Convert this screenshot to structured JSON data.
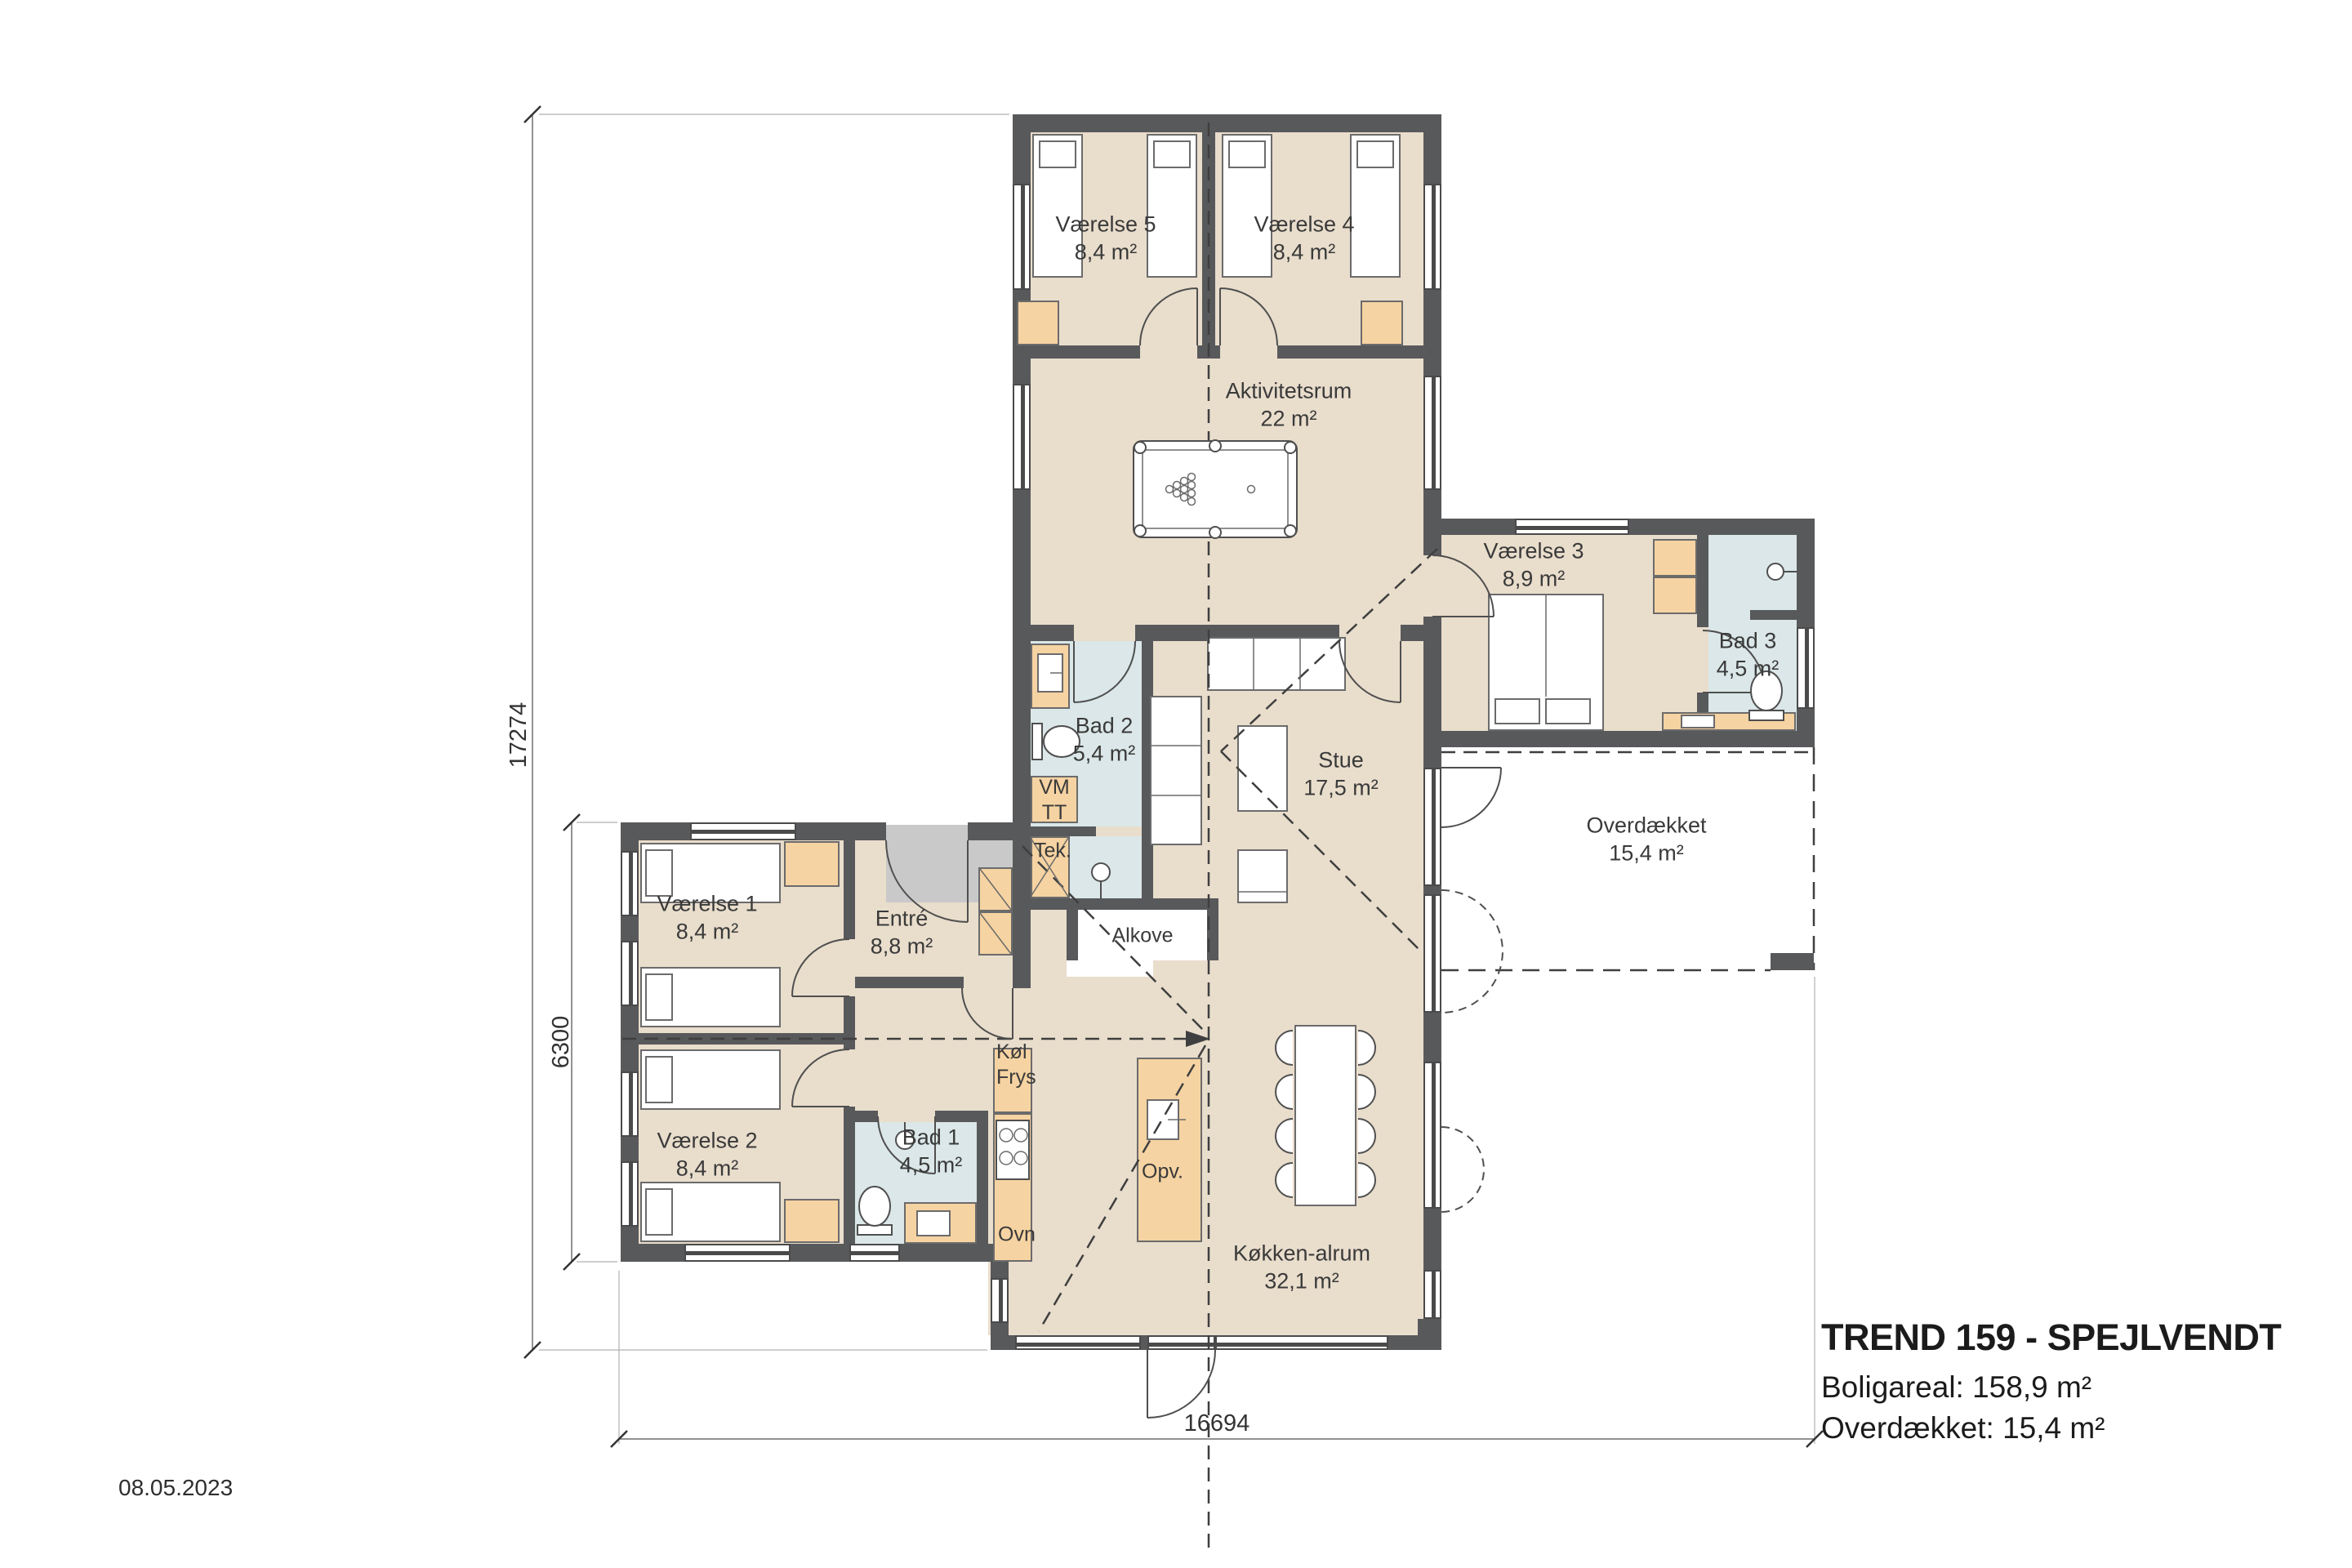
{
  "drawing": {
    "title": "TREND 159 - SPEJLVENDT",
    "area_line1": "Boligareal: 158,9 m²",
    "area_line2": "Overdækket: 15,4 m²",
    "date": "08.05.2023"
  },
  "rooms": {
    "vaerelse5": {
      "name": "Værelse 5",
      "area": "8,4 m²"
    },
    "vaerelse4": {
      "name": "Værelse 4",
      "area": "8,4 m²"
    },
    "aktivitetsrum": {
      "name": "Aktivitetsrum",
      "area": "22 m²"
    },
    "vaerelse3": {
      "name": "Værelse 3",
      "area": "8,9 m²"
    },
    "bad3": {
      "name": "Bad 3",
      "area": "4,5 m²"
    },
    "bad2": {
      "name": "Bad 2",
      "area": "5,4 m²"
    },
    "stue": {
      "name": "Stue",
      "area": "17,5 m²"
    },
    "overdaekket": {
      "name": "Overdækket",
      "area": "15,4 m²"
    },
    "vaerelse1": {
      "name": "Værelse 1",
      "area": "8,4 m²"
    },
    "entre": {
      "name": "Entré",
      "area": "8,8 m²"
    },
    "vaerelse2": {
      "name": "Værelse 2",
      "area": "8,4 m²"
    },
    "bad1": {
      "name": "Bad 1",
      "area": "4,5 m²"
    },
    "koekken": {
      "name": "Køkken-alrum",
      "area": "32,1 m²"
    }
  },
  "fixtures": {
    "tek": "Tek.",
    "vm": "VM",
    "tt": "TT",
    "koel": "Køl",
    "frys": "Frys",
    "ovn": "Ovn",
    "opv": "Opv.",
    "alkove": "Alkove"
  },
  "dimensions": {
    "left_total": "17274",
    "left_wing": "6300",
    "bottom_total": "16694"
  },
  "colors": {
    "wall": "#58595b",
    "floor": "#e9ddcc",
    "wet_room": "#dbe7e8",
    "furniture_accent": "#f6d3a2",
    "doormat": "#c9c9c9"
  }
}
